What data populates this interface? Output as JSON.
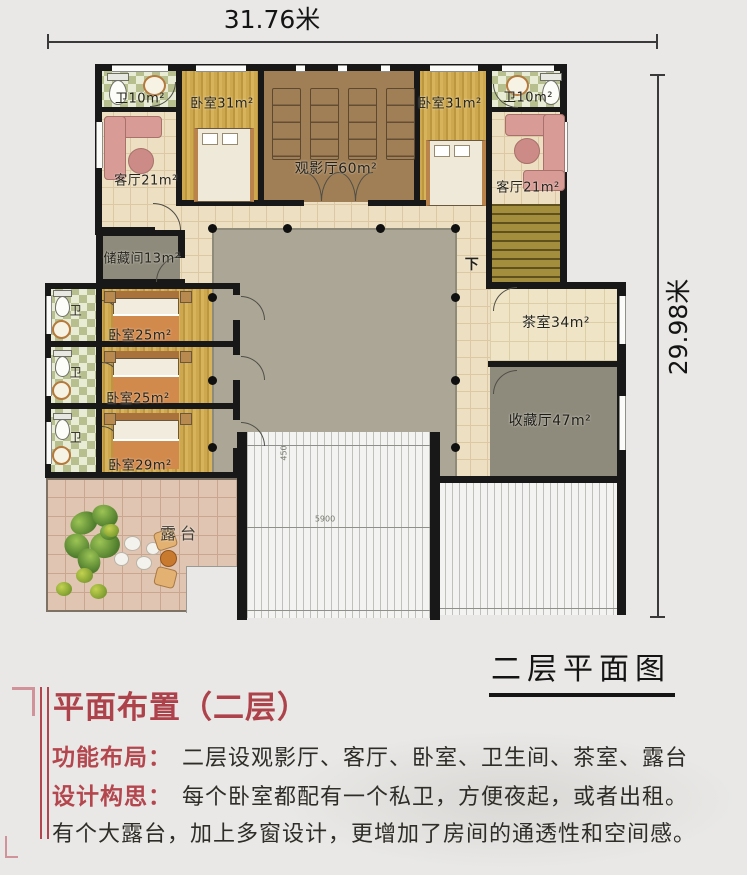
{
  "colors": {
    "accent_red": "#b2434b",
    "wall": "#161616",
    "wood_floor": "#cda84e",
    "courtyard": "#aba695"
  },
  "dimensions": {
    "width": "31.76米",
    "height": "29.98米"
  },
  "plan": {
    "caption": "二层平面图",
    "rooms": {
      "bath_top_left": "卫10m²",
      "bedroom_top_left": "卧室31m²",
      "cinema": "观影厅60m²",
      "bedroom_top_right": "卧室31m²",
      "bath_top_right": "卫10m²",
      "living_left": "客厅21m²",
      "living_right": "客厅21m²",
      "storage": "储藏间13m²",
      "bedroom_mid_1": "卧室25m²",
      "bedroom_mid_2": "卧室25m²",
      "bedroom_bottom": "卧室29m²",
      "bath_small": "卫",
      "tea_room": "茶室34m²",
      "collection_hall": "收藏厅47m²",
      "terrace": "露台",
      "stairs_down": "下"
    },
    "roof_dims": {
      "d450": "450",
      "d5900": "5900"
    }
  },
  "description": {
    "title": "平面布置（二层）",
    "items": [
      {
        "label": "功能布局：",
        "text": "二层设观影厅、客厅、卧室、卫生间、茶室、露台"
      },
      {
        "label": "设计构思：",
        "text": "每个卧室都配有一个私卫，方便夜起，或者出租。"
      },
      {
        "label": "",
        "text": "有个大露台，加上多窗设计，更增加了房间的通透性和空间感。"
      }
    ]
  }
}
